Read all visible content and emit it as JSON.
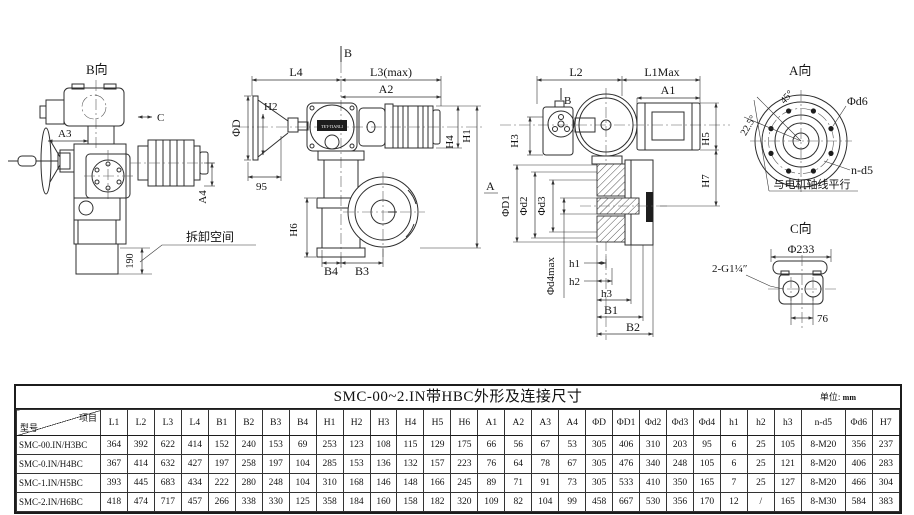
{
  "views": {
    "b_view": {
      "title": "B向",
      "a3": "A3",
      "c": "C",
      "a4": "A4",
      "dim_190": "190",
      "removal_space": "拆卸空间"
    },
    "front_view": {
      "b": "B",
      "l4": "L4",
      "l3max": "L3(max)",
      "a2": "A2",
      "h2": "H2",
      "phi_d": "ΦD",
      "dim_95": "95",
      "h4": "H4",
      "h1": "H1",
      "h6": "H6",
      "b4": "B4",
      "b3": "B3",
      "nameplate": "TET-TIANLI"
    },
    "side_view": {
      "l2": "L2",
      "l1max": "L1Max",
      "a1": "A1",
      "b": "B",
      "a": "A",
      "h3": "H3",
      "h5": "H5",
      "h7": "H7",
      "phi_d1": "ΦD1",
      "phi_d2": "Φd2",
      "phi_d3": "Φd3",
      "phi_d4max": "Φd4max",
      "h1s": "h1",
      "h2s": "h2",
      "h3s": "h3",
      "b1": "B1",
      "b2": "B2"
    },
    "a_view": {
      "title": "A向",
      "phi_d6": "Φd6",
      "n_d5": "n-d5",
      "angle_225": "22.5°",
      "angle_45": "45°",
      "note": "与电机轴线平行"
    },
    "c_view": {
      "title": "C向",
      "phi_233": "Φ233",
      "thread": "2-G1¼″",
      "dim_76": "76"
    }
  },
  "table": {
    "title": "SMC-00~2.IN带HBC外形及连接尺寸",
    "unit_label": "单位:",
    "unit_value": "mm",
    "corner_top": "项目",
    "corner_bottom": "型号",
    "columns": [
      "L1",
      "L2",
      "L3",
      "L4",
      "B1",
      "B2",
      "B3",
      "B4",
      "H1",
      "H2",
      "H3",
      "H4",
      "H5",
      "H6",
      "A1",
      "A2",
      "A3",
      "A4",
      "ΦD",
      "ΦD1",
      "Φd2",
      "Φd3",
      "Φd4",
      "h1",
      "h2",
      "h3",
      "n-d5",
      "Φd6",
      "H7"
    ],
    "rows": [
      {
        "model": "SMC-00.IN/H3BC",
        "values": [
          "364",
          "392",
          "622",
          "414",
          "152",
          "240",
          "153",
          "69",
          "253",
          "123",
          "108",
          "115",
          "129",
          "175",
          "66",
          "56",
          "67",
          "53",
          "305",
          "406",
          "310",
          "203",
          "95",
          "6",
          "25",
          "105",
          "8-M20",
          "356",
          "237"
        ]
      },
      {
        "model": "SMC-0.IN/H4BC",
        "values": [
          "367",
          "414",
          "632",
          "427",
          "197",
          "258",
          "197",
          "104",
          "285",
          "153",
          "136",
          "132",
          "157",
          "223",
          "76",
          "64",
          "78",
          "67",
          "305",
          "476",
          "340",
          "248",
          "105",
          "6",
          "25",
          "121",
          "8-M20",
          "406",
          "283"
        ]
      },
      {
        "model": "SMC-1.IN/H5BC",
        "values": [
          "393",
          "445",
          "683",
          "434",
          "222",
          "280",
          "248",
          "104",
          "310",
          "168",
          "146",
          "148",
          "166",
          "245",
          "89",
          "71",
          "91",
          "73",
          "305",
          "533",
          "410",
          "350",
          "165",
          "7",
          "25",
          "127",
          "8-M20",
          "466",
          "304"
        ]
      },
      {
        "model": "SMC-2.IN/H6BC",
        "values": [
          "418",
          "474",
          "717",
          "457",
          "266",
          "338",
          "330",
          "125",
          "358",
          "184",
          "160",
          "158",
          "182",
          "320",
          "109",
          "82",
          "104",
          "99",
          "458",
          "667",
          "530",
          "356",
          "170",
          "12",
          "/",
          "165",
          "8-M30",
          "584",
          "383"
        ]
      }
    ]
  }
}
